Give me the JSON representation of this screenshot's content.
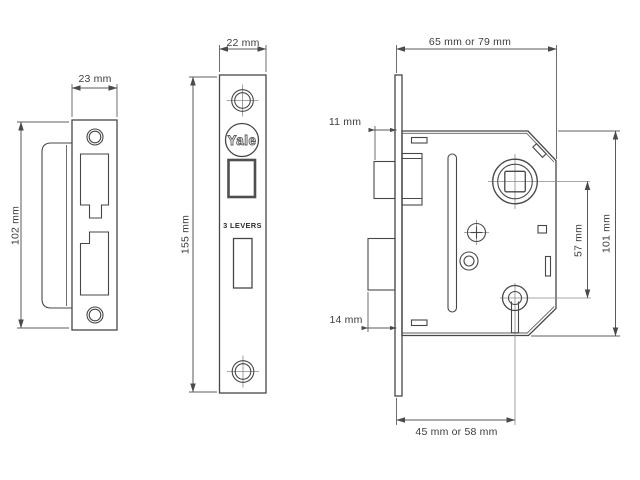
{
  "background_color": "#ffffff",
  "line_color": "#474747",
  "text_color": "#3d3d3d",
  "brand": {
    "logo_text": "Yale"
  },
  "faceplate": {
    "marking": "3 LEVERS"
  },
  "dims": {
    "strike_width": "23 mm",
    "strike_height": "102 mm",
    "faceplate_width": "22 mm",
    "faceplate_height": "155 mm",
    "case_depth": "65 mm or 79 mm",
    "latch_projection": "11 mm",
    "deadbolt_projection": "14 mm",
    "spindle_to_keyhole": "57 mm",
    "case_height": "101 mm",
    "backset": "45 mm or 58 mm"
  }
}
